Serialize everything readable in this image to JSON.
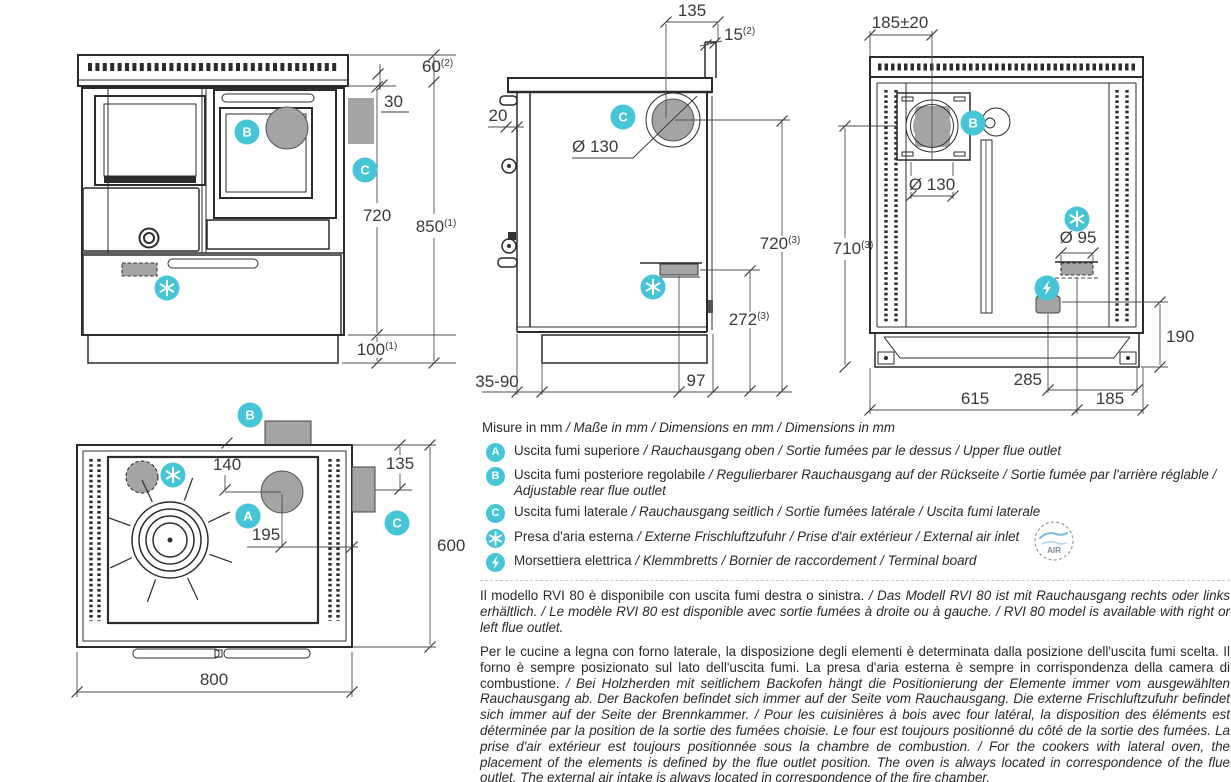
{
  "colors": {
    "accent_teal": "#45c5d5",
    "fill_grey": "#a4a4a4",
    "line": "#2c2c2c"
  },
  "badges": {
    "a": "A",
    "b": "B",
    "c": "C"
  },
  "dims": {
    "front": {
      "h60": "60",
      "h60_sup": "(2)",
      "gap30": "30",
      "h720": "720",
      "h850": "850",
      "h850_sup": "(1)",
      "h100": "100",
      "h100_sup": "(1)"
    },
    "side": {
      "w135": "135",
      "w15": "15",
      "w15_sup": "(2)",
      "w20": "20",
      "dia130": "Ø 130",
      "h720": "720",
      "h720_sup": "(3)",
      "h272": "272",
      "h272_sup": "(3)",
      "feet": "35-90",
      "w97": "97"
    },
    "rear": {
      "w185pm": "185±20",
      "dia130": "Ø 130",
      "h710": "710",
      "h710_sup": "(3)",
      "dia95": "Ø 95",
      "h190": "190",
      "w285": "285",
      "w615": "615",
      "w185": "185"
    },
    "top": {
      "d140": "140",
      "d135": "135",
      "d195": "195",
      "d600": "600",
      "d800": "800"
    }
  },
  "legend": {
    "title": {
      "it": "Misure in mm",
      "rest": " / Maße in mm / Dimensions en mm / Dimensions in mm"
    },
    "items": [
      {
        "it": "Uscita fumi superiore",
        "rest": " / Rauchausgang oben  / Sortie fumées par le dessus / Upper flue outlet"
      },
      {
        "it": "Uscita fumi posteriore regolabile",
        "rest": " /  Regulierbarer Rauchausgang auf der Rückseite / Sortie fumée par l'arrière réglable / Adjustable rear flue outlet"
      },
      {
        "it": "Uscita fumi laterale",
        "rest": " / Rauchausgang seitlich  / Sortie fumées latérale / Uscita fumi laterale"
      },
      {
        "it": "Presa d'aria esterna",
        "rest": " / Externe Frischluftzufuhr / Prise d'air extérieur / External air inlet"
      },
      {
        "it": "Morsettiera elettrica",
        "rest": " / Klemmbretts / Bornier de raccordement / Terminal board"
      }
    ],
    "air_logo_text": "AIR"
  },
  "notes": [
    {
      "it": "Il modello RVI 80 è disponibile con uscita fumi destra o sinistra.",
      "rest": " / Das Modell RVI 80 ist mit Rauchausgang rechts oder links erhältlich. / Le modèle RVI 80 est disponible avec sortie fumées à droite ou à gauche. / RVI 80 model is available with right or left flue outlet."
    },
    {
      "it": "Per le cucine a legna con forno laterale, la disposizione degli elementi è determinata dalla posizione dell'uscita fumi scelta. Il forno è sempre posizionato sul lato dell'uscita fumi. La presa d'aria esterna è sempre in corrispondenza della camera di combustione.",
      "rest": " / Bei Holzherden mit seitlichem Backofen hängt die Positionierung der Elemente immer vom ausgewählten Rauchausgang ab. Der Backofen befindet sich immer auf der Seite vom Rauchausgang. Die externe Frischluftzufuhr befindet sich immer auf der Seite der Brennkammer. / Pour les cuisinières à bois avec four latéral, la disposition des éléments est déterminée par la position de la sortie des fumées choisie. Le four est toujours positionné du côté de la sortie des fumées. La prise d'air extérieur est toujours positionnée sous la chambre de combustion. / For the cookers with lateral oven, the placement of the elements is defined by the flue outlet position. The oven is always located in correspondence of the flue outlet. The external air intake is always located in correspondence of the fire chamber."
    }
  ]
}
